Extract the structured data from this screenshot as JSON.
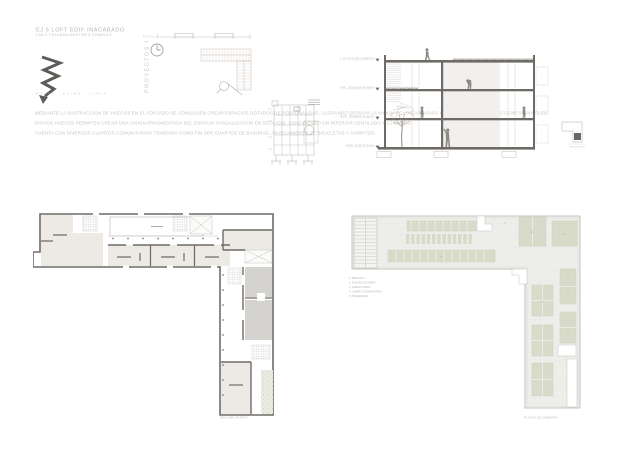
{
  "title": {
    "line1": "EJ 5   LOFT EDIF INACABADO",
    "line2": "LAB 3   YOLANDA MARTINEZ DOMINGO",
    "vertical": "PROYECTOS I",
    "author": "MARIA  CAIRO  CIRIA"
  },
  "scale_bar": {
    "label": "ESCALA"
  },
  "description": {
    "p1": "MEDIANTE LA SUSTRACCION DE HUECOS EN EL FORJADO SE CONSIGUEN CREAR ESPACIOS DOTADOS DE PERSONALIDAD, LOGRANDO DESVIAR LA VISION DE LOS USUARIOS EN LAS DIFERENTES DIRECCIONES Y NIVELES.",
    "p2": "DICHOS HUECOS PERMITEN CREAR UNA VISION FRAGMENTADA DEL ESPACIO (VISUALIZACION EN SECCION), CONFIRIENDO UN INTERIOR VENTILADO Y LUMINOSO.",
    "p3": "CUENTA CON DIVERSOS CUARTOS COMUNITARIOS TENIENDO COMO FIN SER CUARTOS DE BASURAS, APARCAMIENTO DE BICICLETAS Y CARRITOS..."
  },
  "section": {
    "levels": [
      "NIVEL PLANTA DE CUBIERTA",
      "NIVEL SEGUNDA PLANTA",
      "NIVEL PRIMERA PLANTA",
      "NIVEL PLANTA BAJA"
    ],
    "key_caption": "SECCION TIPO"
  },
  "plans": {
    "second_floor": {
      "caption": "SEGUNDA PLANTA"
    },
    "roof": {
      "caption": "PLANTA DE CUBIERTA",
      "legend": [
        "1.  PERGOLA",
        "2.  PLACAS SOLARES",
        "3.  LAMAS VIDRIO",
        "4.  CUARTO COMUNITARIO",
        "5.  TENDEDERO"
      ],
      "markers": [
        "1",
        "2",
        "3",
        "4",
        "5"
      ]
    }
  },
  "colors": {
    "background": "#ffffff",
    "wall_dark": "#6e6a66",
    "people_gray": "#8d8a86",
    "room_beige": "#edeae5",
    "room_gray": "#d5d3d0",
    "roof_deck": "#ebece8",
    "roof_green": "#d9dbca",
    "light_text": "#c6c3bf"
  }
}
